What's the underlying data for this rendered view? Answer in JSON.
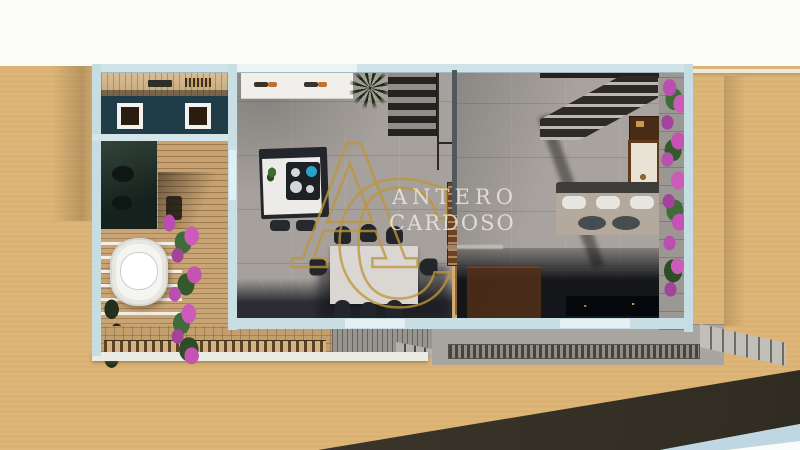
{
  "watermark": {
    "monogram_left": "A",
    "monogram_right": "C",
    "name_line1": "ANTERO",
    "name_line2": "CARDOSO"
  },
  "palette": {
    "sky_white": "#fbfbfa",
    "sand_ground": "#dbb273",
    "site_shadow_olive": "#3a352a",
    "wall_light_blue": "#c6dde2",
    "entry_roof_teal": "#1f3c48",
    "pergola_wood": "#d7b685",
    "deck_wood": "#c49f6e",
    "tile_gray": "#a6a19d",
    "stair_dark": "#24231f",
    "island_white": "#edebe7",
    "cooktop_black": "#1d2025",
    "kettle_blue": "#2aa3cb",
    "dining_table": "#dad6d1",
    "chair_dark": "#22252a",
    "sofa_beige": "#b4a99d",
    "console_wood": "#5f3a1f",
    "bougainvillea_purple": "#c553b1",
    "leaf_green": "#3f6c38",
    "bathtub_white": "#f4f4f1",
    "watermark_gold": "#be963c",
    "watermark_text": "#f2eee6"
  }
}
